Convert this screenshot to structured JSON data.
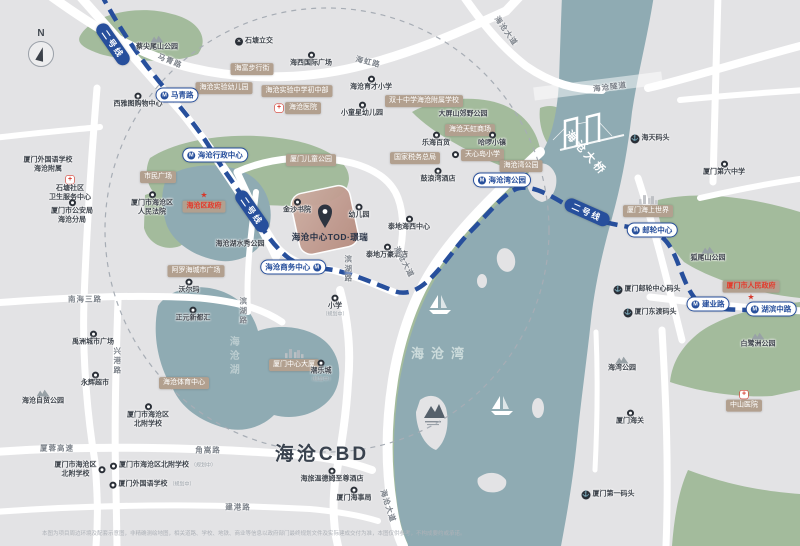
{
  "compass": {
    "label": "N"
  },
  "site": {
    "name": "海沧中心TOD·璟瑞"
  },
  "colors": {
    "land": "#e3e3e5",
    "water": "#8fabb3",
    "park": "#a3bb9c",
    "road": "#ffffff",
    "metro_blue": "#274f9c",
    "tag_tan": "#b2a08f",
    "site_pink": "#c3a094",
    "red": "#d6372a"
  },
  "disclaimer": "本图为项目周边环境及配套示意图，非精确测绘地图，相关道路、学校、地铁、商业等信息以政府部门最终规划文件及实际建成交付为准，本图仅供参考，不构成要约或承诺。",
  "labels": [
    {
      "t": "蔡尖尾山公园",
      "x": 157,
      "y": 44,
      "ty": "poi",
      "ic": "mountain",
      "ip": "above"
    },
    {
      "t": "石塘立交",
      "x": 254,
      "y": 42,
      "ty": "poi",
      "ic": "interchange",
      "ip": "left"
    },
    {
      "t": "马青路",
      "x": 170,
      "y": 61,
      "ty": "road",
      "r": 22
    },
    {
      "t": "海虹路",
      "x": 368,
      "y": 62,
      "ty": "road",
      "r": 14
    },
    {
      "t": "海沧大道",
      "x": 506,
      "y": 31,
      "ty": "road",
      "r": 55
    },
    {
      "t": "海富步行街",
      "x": 252,
      "y": 69,
      "ty": "tag"
    },
    {
      "t": "海沧实验幼儿园",
      "x": 224,
      "y": 88,
      "ty": "tag"
    },
    {
      "t": "海西国际广场",
      "x": 311,
      "y": 60,
      "ty": "poi",
      "ic": "dot",
      "ip": "above"
    },
    {
      "t": "海沧实验中学初中部",
      "x": 297,
      "y": 91,
      "ty": "tag"
    },
    {
      "t": "海沧育才小学",
      "x": 371,
      "y": 84,
      "ty": "poi",
      "ic": "dot",
      "ip": "above"
    },
    {
      "t": "双十中学海沧附属学校",
      "x": 424,
      "y": 101,
      "ty": "tag"
    },
    {
      "t": "海沧医院",
      "x": 298,
      "y": 108,
      "ty": "tag",
      "ic": "cross",
      "ip": "left"
    },
    {
      "t": "小童星幼儿园",
      "x": 362,
      "y": 110,
      "ty": "poi",
      "ic": "dot",
      "ip": "above"
    },
    {
      "t": "大屏山郊野公园",
      "x": 463,
      "y": 115,
      "ty": "poi"
    },
    {
      "t": "海沧天虹商场",
      "x": 470,
      "y": 130,
      "ty": "tag"
    },
    {
      "t": "乐海百货",
      "x": 436,
      "y": 140,
      "ty": "poi",
      "ic": "dot",
      "ip": "above"
    },
    {
      "t": "哈啰小镇",
      "x": 492,
      "y": 140,
      "ty": "poi",
      "ic": "dot",
      "ip": "above"
    },
    {
      "t": "天心岛小学",
      "x": 478,
      "y": 155,
      "ty": "tag",
      "ic": "dot",
      "ip": "left"
    },
    {
      "t": "厦门儿童公园",
      "x": 311,
      "y": 160,
      "ty": "tag"
    },
    {
      "t": "国家税务总局",
      "x": 415,
      "y": 158,
      "ty": "tag"
    },
    {
      "t": "鼓浪湾酒店",
      "x": 438,
      "y": 176,
      "ty": "poi",
      "ic": "dot",
      "ip": "above"
    },
    {
      "t": "海沧隧道",
      "x": 610,
      "y": 87,
      "ty": "road",
      "r": -7
    },
    {
      "t": "海天码头",
      "x": 650,
      "y": 139,
      "ty": "poi",
      "ic": "anchor",
      "ip": "left"
    },
    {
      "t": "厦门第六中学",
      "x": 724,
      "y": 169,
      "ty": "poi",
      "ic": "dot",
      "ip": "above"
    },
    {
      "t": "海沧大桥",
      "x": 585,
      "y": 154,
      "ty": "bridge",
      "r": 48
    },
    {
      "t": "厦门外国语学校\n海沧附属",
      "x": 48,
      "y": 165,
      "ty": "poi"
    },
    {
      "t": "石塘社区\n卫生服务中心",
      "x": 70,
      "y": 189,
      "ty": "poi",
      "ic": "cross",
      "ip": "above"
    },
    {
      "t": "厦门市公安局\n海沧分局",
      "x": 72,
      "y": 212,
      "ty": "poi",
      "ic": "dot",
      "ip": "above"
    },
    {
      "t": "市民广场",
      "x": 158,
      "y": 177,
      "ty": "tag"
    },
    {
      "t": "厦门市海沧区\n人民法院",
      "x": 152,
      "y": 204,
      "ty": "poi",
      "ic": "dot",
      "ip": "above"
    },
    {
      "t": "海沧区政府",
      "x": 204,
      "y": 202,
      "ty": "tag",
      "red": true,
      "ic": "star",
      "ip": "above"
    },
    {
      "t": "海沧行政中心",
      "x": 215,
      "y": 155,
      "ty": "metro"
    },
    {
      "t": "马青路",
      "x": 177,
      "y": 95,
      "ty": "metro"
    },
    {
      "t": "西雅图购物中心",
      "x": 138,
      "y": 101,
      "ty": "poi",
      "ic": "dot",
      "ip": "above"
    },
    {
      "t": "二号线",
      "x": 113,
      "y": 44,
      "ty": "badge",
      "r": 55
    },
    {
      "t": "二号线",
      "x": 252,
      "y": 211,
      "ty": "badge",
      "r": 55
    },
    {
      "t": "二号线",
      "x": 587,
      "y": 212,
      "ty": "badge",
      "r": 24
    },
    {
      "t": "海沧湖水秀公园",
      "x": 240,
      "y": 245,
      "ty": "poi"
    },
    {
      "t": "金沙书院",
      "x": 297,
      "y": 207,
      "ty": "poi",
      "ic": "dot",
      "ip": "above"
    },
    {
      "t": "幼儿园",
      "x": 359,
      "y": 212,
      "ty": "poi",
      "ic": "dot",
      "ip": "above"
    },
    {
      "t": "泰地海西中心",
      "x": 409,
      "y": 224,
      "ty": "poi",
      "ic": "dot",
      "ip": "above"
    },
    {
      "t": "泰地万豪酒店",
      "x": 387,
      "y": 252,
      "ty": "poi",
      "ic": "dot",
      "ip": "above"
    },
    {
      "t": "海沧商务中心",
      "x": 293,
      "y": 267,
      "ty": "metro",
      "mp": "r"
    },
    {
      "t": "滨湖路",
      "x": 348,
      "y": 269,
      "ty": "road",
      "v": true
    },
    {
      "t": "滨湖路",
      "x": 243,
      "y": 311,
      "ty": "road",
      "v": true
    },
    {
      "t": "海沧大道",
      "x": 404,
      "y": 262,
      "ty": "road",
      "r": 62
    },
    {
      "t": "阿罗海城市广场",
      "x": 196,
      "y": 271,
      "ty": "tag"
    },
    {
      "t": "沃尔玛",
      "x": 189,
      "y": 287,
      "ty": "poi",
      "ic": "dot",
      "ip": "above"
    },
    {
      "t": "南海三路",
      "x": 85,
      "y": 299,
      "ty": "road"
    },
    {
      "t": "正元新都汇",
      "x": 193,
      "y": 315,
      "ty": "poi",
      "ic": "dot",
      "ip": "above"
    },
    {
      "t": "禹洲城市广场",
      "x": 93,
      "y": 339,
      "ty": "poi",
      "ic": "dot",
      "ip": "above"
    },
    {
      "t": "小学",
      "x": 335,
      "y": 306,
      "ty": "poi",
      "ic": "dot",
      "ip": "above",
      "s": "（规划中）"
    },
    {
      "t": "海沧湾公园",
      "x": 521,
      "y": 166,
      "ty": "tag"
    },
    {
      "t": "海沧湾公园",
      "x": 502,
      "y": 180,
      "ty": "metro"
    },
    {
      "t": "厦门海上世界",
      "x": 648,
      "y": 206,
      "ty": "tag",
      "ic": "skyline",
      "ip": "above"
    },
    {
      "t": "邮轮中心",
      "x": 652,
      "y": 230,
      "ty": "metro"
    },
    {
      "t": "狐尾山公园",
      "x": 708,
      "y": 255,
      "ty": "poi",
      "ic": "mountain",
      "ip": "above"
    },
    {
      "t": "厦门邮轮中心码头",
      "x": 647,
      "y": 290,
      "ty": "poi",
      "ic": "anchor",
      "ip": "left"
    },
    {
      "t": "厦门东渡码头",
      "x": 650,
      "y": 313,
      "ty": "poi",
      "ic": "anchor",
      "ip": "left"
    },
    {
      "t": "厦门市人民政府",
      "x": 751,
      "y": 291,
      "ty": "tag",
      "red": true,
      "ic": "star",
      "ip": "below"
    },
    {
      "t": "建业路",
      "x": 708,
      "y": 304,
      "ty": "metro"
    },
    {
      "t": "湖滨中路",
      "x": 771,
      "y": 309,
      "ty": "metro"
    },
    {
      "t": "海沧湖",
      "x": 232,
      "y": 357,
      "ty": "water",
      "v": true
    },
    {
      "t": "海沧湾",
      "x": 441,
      "y": 354,
      "ty": "water"
    },
    {
      "t": "厦门中心大厦",
      "x": 294,
      "y": 360,
      "ty": "tag",
      "ic": "skyline",
      "ip": "above"
    },
    {
      "t": "潮乐城",
      "x": 321,
      "y": 371,
      "ty": "poi",
      "ic": "dot",
      "ip": "above",
      "s": "（规划中）"
    },
    {
      "t": "海沧体育中心",
      "x": 184,
      "y": 383,
      "ty": "tag"
    },
    {
      "t": "永辉超市",
      "x": 95,
      "y": 380,
      "ty": "poi",
      "ic": "dot",
      "ip": "above"
    },
    {
      "t": "海沧自贸公园",
      "x": 43,
      "y": 398,
      "ty": "poi",
      "ic": "mountain",
      "ip": "above"
    },
    {
      "t": "厦门市海沧区\n北附学校",
      "x": 148,
      "y": 416,
      "ty": "poi",
      "ic": "dot",
      "ip": "above"
    },
    {
      "t": "兴港路",
      "x": 117,
      "y": 361,
      "ty": "road",
      "v": true
    },
    {
      "t": "白鹭洲公园",
      "x": 758,
      "y": 341,
      "ty": "poi",
      "ic": "mountain",
      "ip": "above"
    },
    {
      "t": "海湾公园",
      "x": 622,
      "y": 365,
      "ty": "poi",
      "ic": "mountain",
      "ip": "above"
    },
    {
      "t": "中山医院",
      "x": 744,
      "y": 401,
      "ty": "tag",
      "ic": "cross",
      "ip": "above"
    },
    {
      "t": "厦门海关",
      "x": 630,
      "y": 418,
      "ty": "poi",
      "ic": "dot",
      "ip": "above"
    },
    {
      "t": "海沧CBD",
      "x": 322,
      "y": 455,
      "ty": "big"
    },
    {
      "t": "厦蓉高速",
      "x": 57,
      "y": 448,
      "ty": "road"
    },
    {
      "t": "角嵩路",
      "x": 208,
      "y": 450,
      "ty": "road"
    },
    {
      "t": "厦门市海沧区\n北附学校",
      "x": 80,
      "y": 470,
      "ty": "poi",
      "ic": "dot",
      "ip": "right"
    },
    {
      "t": "厦门市海沧区北附学校",
      "x": 163,
      "y": 466,
      "ty": "poi",
      "ic": "dot",
      "ip": "left",
      "s": "（规划中）"
    },
    {
      "t": "厦门外国语学校",
      "x": 152,
      "y": 485,
      "ty": "poi",
      "ic": "dot",
      "ip": "left",
      "s": "（规划中）"
    },
    {
      "t": "海旅温德姆至尊酒店",
      "x": 332,
      "y": 476,
      "ty": "poi",
      "ic": "dot",
      "ip": "above"
    },
    {
      "t": "厦门海事局",
      "x": 354,
      "y": 495,
      "ty": "poi",
      "ic": "dot",
      "ip": "above"
    },
    {
      "t": "建港路",
      "x": 238,
      "y": 507,
      "ty": "road"
    },
    {
      "t": "海沧大道",
      "x": 388,
      "y": 506,
      "ty": "road",
      "r": 72
    },
    {
      "t": "厦门第一码头",
      "x": 608,
      "y": 495,
      "ty": "poi",
      "ic": "anchor",
      "ip": "left"
    }
  ]
}
